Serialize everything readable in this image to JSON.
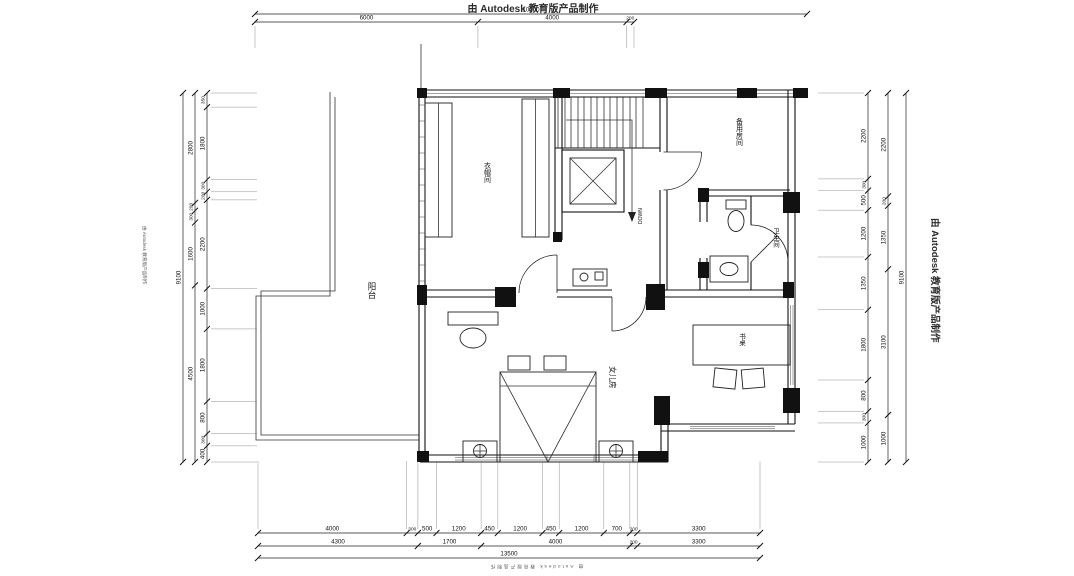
{
  "watermark": {
    "text": "由 Autodesk 教育版产品制作"
  },
  "rooms": {
    "balcony": "阳台",
    "cloakroom": "衣帽间",
    "spare_room": "备用房间",
    "bathroom": "卫生间",
    "daughter_room": "女儿房",
    "desk": "书桌",
    "stair_direction": "DOWN"
  },
  "dimensions": {
    "top_total": "10200",
    "top": [
      "6000",
      "4000",
      "200"
    ],
    "bottom_row1": [
      "4000",
      "300",
      "500",
      "1200",
      "450",
      "1200",
      "450",
      "1200",
      "700",
      "200",
      "3300"
    ],
    "bottom_row2": [
      "4300",
      "1700",
      "4000",
      "200",
      "3300"
    ],
    "bottom_total": "13500",
    "left_inner": [
      "350",
      "1800",
      "300",
      "200",
      "2200",
      "1000",
      "1800",
      "800",
      "300",
      "400"
    ],
    "left_mid": [
      "2800",
      "200",
      "300",
      "1600",
      "4500"
    ],
    "left_total": "9100",
    "right_inner": [
      "2200",
      "300",
      "500",
      "1200",
      "1350",
      "1800",
      "800",
      "300",
      "1000"
    ],
    "right_mid": [
      "2200",
      "200",
      "1350",
      "3100",
      "1000"
    ],
    "right_total": "9100"
  }
}
